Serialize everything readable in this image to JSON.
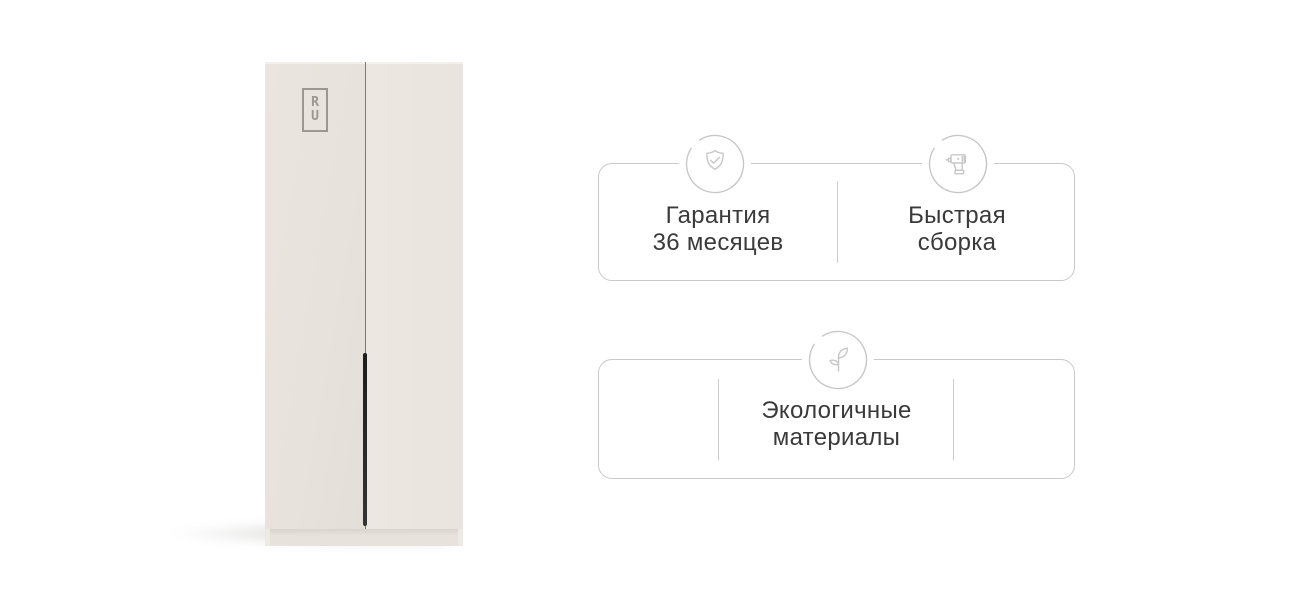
{
  "colors": {
    "background": "#ffffff",
    "card_border": "#c9c9c9",
    "divider": "#cccccc",
    "icon_stroke": "#c7c7c7",
    "text": "#3a3a3a",
    "wardrobe_body": "#e9e4dd",
    "wardrobe_handle": "#242424",
    "wardrobe_logo": "#9c978f"
  },
  "wardrobe": {
    "logo_letters": {
      "top": "R",
      "bottom": "U"
    }
  },
  "cards": [
    {
      "features": [
        {
          "icon": "shield-check-icon",
          "lines": [
            "Гарантия",
            "36 месяцев"
          ]
        },
        {
          "icon": "drill-icon",
          "lines": [
            "Быстрая",
            "сборка"
          ]
        }
      ]
    },
    {
      "features": [
        {
          "icon": "sprout-icon",
          "lines": [
            "Экологичные",
            "материалы"
          ]
        }
      ]
    }
  ]
}
